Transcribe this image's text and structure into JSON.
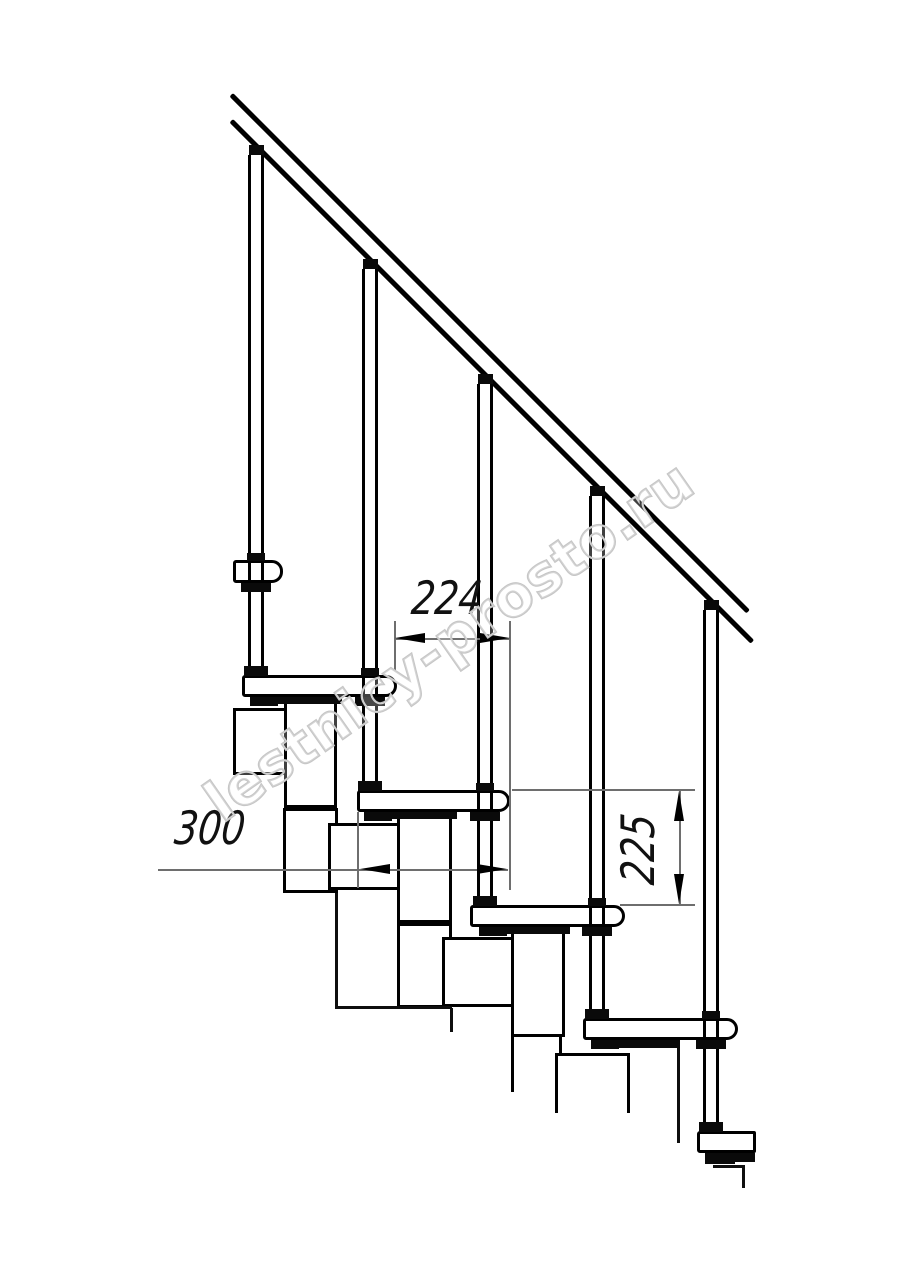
{
  "watermark": {
    "text": "lestnicy-prosto.ru",
    "color": "#c6c6c6"
  },
  "colors": {
    "background": "#ffffff",
    "line": "#000000",
    "thin_dimension_line": "#6e6e6e",
    "text": "#111111"
  },
  "dimensions": {
    "run": {
      "label": "224",
      "orientation": "horizontal"
    },
    "depth": {
      "label": "300",
      "orientation": "horizontal"
    },
    "rise": {
      "label": "225",
      "orientation": "vertical"
    }
  },
  "figure": {
    "kind": "staircase-side-elevation",
    "description": "Side view of a modular staircase: diagonal handrail on five balusters, five treads with rounded noses on stacked support modules, with step-run 224, tread-depth 300 and rise 225 callouts",
    "rail": {
      "x": 233,
      "y_upper": 93,
      "y_lower": 119,
      "length_upper": 731,
      "length_lower": 737,
      "thickness": 4.5
    },
    "treads": [
      {
        "x": 233,
        "y": 560,
        "w": 50,
        "h": 23
      },
      {
        "x": 242,
        "y": 675,
        "w": 155,
        "h": 22
      },
      {
        "x": 357,
        "y": 790,
        "w": 153,
        "h": 22
      },
      {
        "x": 470,
        "y": 905,
        "w": 155,
        "h": 22
      },
      {
        "x": 583,
        "y": 1018,
        "w": 155,
        "h": 22
      },
      {
        "x": 697,
        "y": 1131,
        "w": 59,
        "h": 22,
        "cut": true
      }
    ],
    "balusters": [
      {
        "cx": 256,
        "top": 155,
        "foot": 675
      },
      {
        "cx": 370,
        "top": 269,
        "foot": 790
      },
      {
        "cx": 485,
        "top": 384,
        "foot": 905
      },
      {
        "cx": 597,
        "top": 496,
        "foot": 1018
      },
      {
        "cx": 711,
        "top": 610,
        "foot": 1131
      }
    ],
    "modules": [
      {
        "x": 233,
        "y": 708,
        "w": 56,
        "h": 67,
        "sides": "ltrb"
      },
      {
        "x": 284,
        "y": 703,
        "w": 53,
        "h": 105,
        "sides": "lrb"
      },
      {
        "x": 283,
        "y": 808,
        "w": 55,
        "h": 85,
        "sides": "ltrb"
      },
      {
        "x": 328,
        "y": 823,
        "w": 75,
        "h": 67,
        "sides": "ltrb"
      },
      {
        "x": 397,
        "y": 812,
        "w": 55,
        "h": 111,
        "sides": "lrb"
      },
      {
        "x": 397,
        "y": 923,
        "w": 55,
        "h": 85,
        "sides": "ltrb"
      },
      {
        "x": 442,
        "y": 937,
        "w": 75,
        "h": 70,
        "sides": "ltrb"
      },
      {
        "x": 511,
        "y": 927,
        "w": 54,
        "h": 110,
        "sides": "lrb"
      },
      {
        "x": 511,
        "y": 1037,
        "w": 51,
        "h": 55,
        "sides": "lr"
      },
      {
        "x": 555,
        "y": 1053,
        "w": 75,
        "h": 60,
        "sides": "ltr"
      }
    ],
    "black_marks": [
      [
        247,
        553,
        18,
        8
      ],
      [
        361,
        668,
        18,
        8
      ],
      [
        476,
        783,
        18,
        8
      ],
      [
        588,
        898,
        18,
        8
      ],
      [
        702,
        1011,
        18,
        8
      ],
      [
        244,
        666,
        24,
        10
      ],
      [
        358,
        781,
        24,
        10
      ],
      [
        473,
        896,
        24,
        10
      ],
      [
        585,
        1009,
        24,
        10
      ],
      [
        699,
        1122,
        24,
        10
      ],
      [
        241,
        583,
        30,
        9
      ],
      [
        355,
        697,
        30,
        9
      ],
      [
        470,
        812,
        30,
        9
      ],
      [
        582,
        927,
        30,
        9
      ],
      [
        696,
        1040,
        30,
        9
      ],
      [
        250,
        697,
        28,
        9
      ],
      [
        364,
        812,
        28,
        9
      ],
      [
        479,
        927,
        28,
        9
      ],
      [
        591,
        1040,
        28,
        9
      ],
      [
        705,
        1153,
        30,
        11
      ],
      [
        277,
        697,
        65,
        7
      ],
      [
        392,
        812,
        65,
        7
      ],
      [
        505,
        927,
        65,
        7
      ],
      [
        618,
        1040,
        62,
        8
      ],
      [
        727,
        1153,
        28,
        9
      ]
    ],
    "thin_black_lines": [
      [
        335,
        893,
        3,
        115
      ],
      [
        335,
        1006,
        117,
        3
      ],
      [
        450,
        1008,
        3,
        24
      ],
      [
        677,
        1047,
        3,
        96
      ],
      [
        713,
        1165,
        31,
        3
      ],
      [
        742,
        1165,
        3,
        23
      ]
    ]
  }
}
